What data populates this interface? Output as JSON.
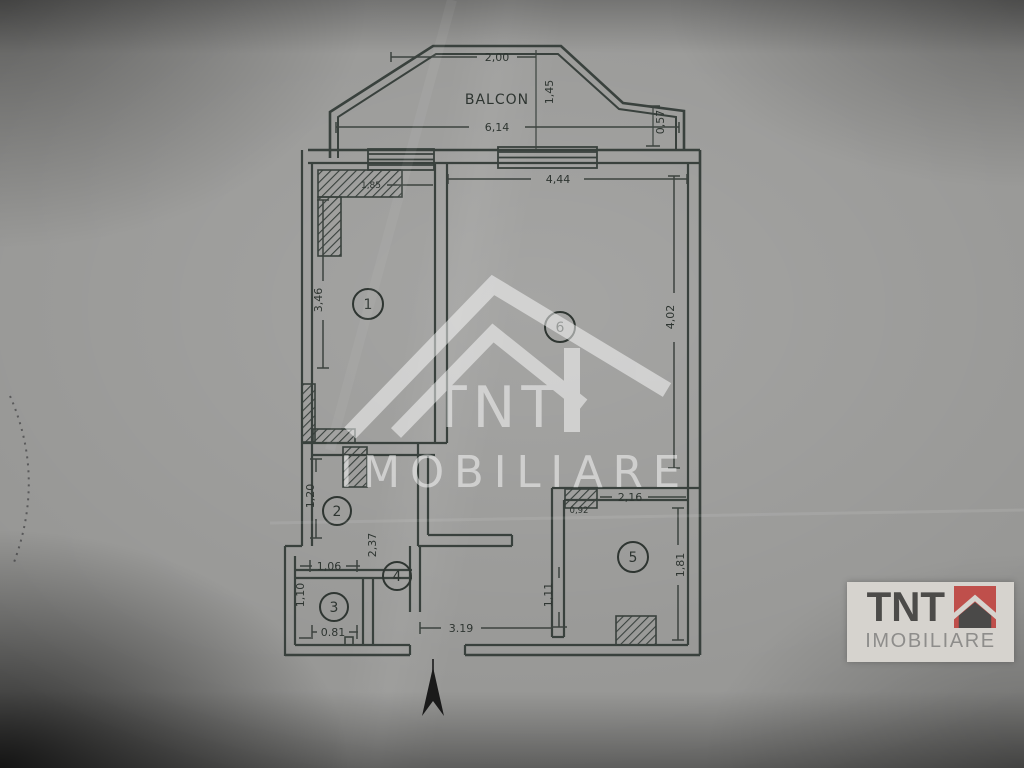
{
  "photo": {
    "paper_color": "#949492",
    "ink_color": "#343b37"
  },
  "plan": {
    "balcony_label": "BALCON",
    "rooms": [
      {
        "number": "1"
      },
      {
        "number": "2"
      },
      {
        "number": "3"
      },
      {
        "number": "4"
      },
      {
        "number": "5"
      },
      {
        "number": "6"
      }
    ],
    "dims": {
      "balcony_top_width": "2,00",
      "balcony_depth": "1,45",
      "balcony_width": "6,14",
      "balcony_side_offset": "0,57",
      "living_top_width": "4,44",
      "closet_width": "1,85",
      "room1_length": "3,46",
      "room6_length": "4,02",
      "room2_length": "1,20",
      "hall_length": "2,37",
      "vestibule_width": "1,06",
      "bath_length": "1,10",
      "entry_door_width": "0.81",
      "hall_width": "3.19",
      "hall_side": "1,11",
      "kitchen_top_width": "2,16",
      "kitchen_niche": "0,92",
      "kitchen_side": "1,81"
    }
  },
  "watermark": {
    "brand": "TNT",
    "subtitle": "IMOBILIARE"
  },
  "logo": {
    "brand": "TNT",
    "subtitle": "IMOBILIARE",
    "accent_color": "#bf4f4b",
    "text_color": "#4c4b49",
    "subtitle_color": "#8e8d8b",
    "card_color": "#d6d3ce"
  }
}
